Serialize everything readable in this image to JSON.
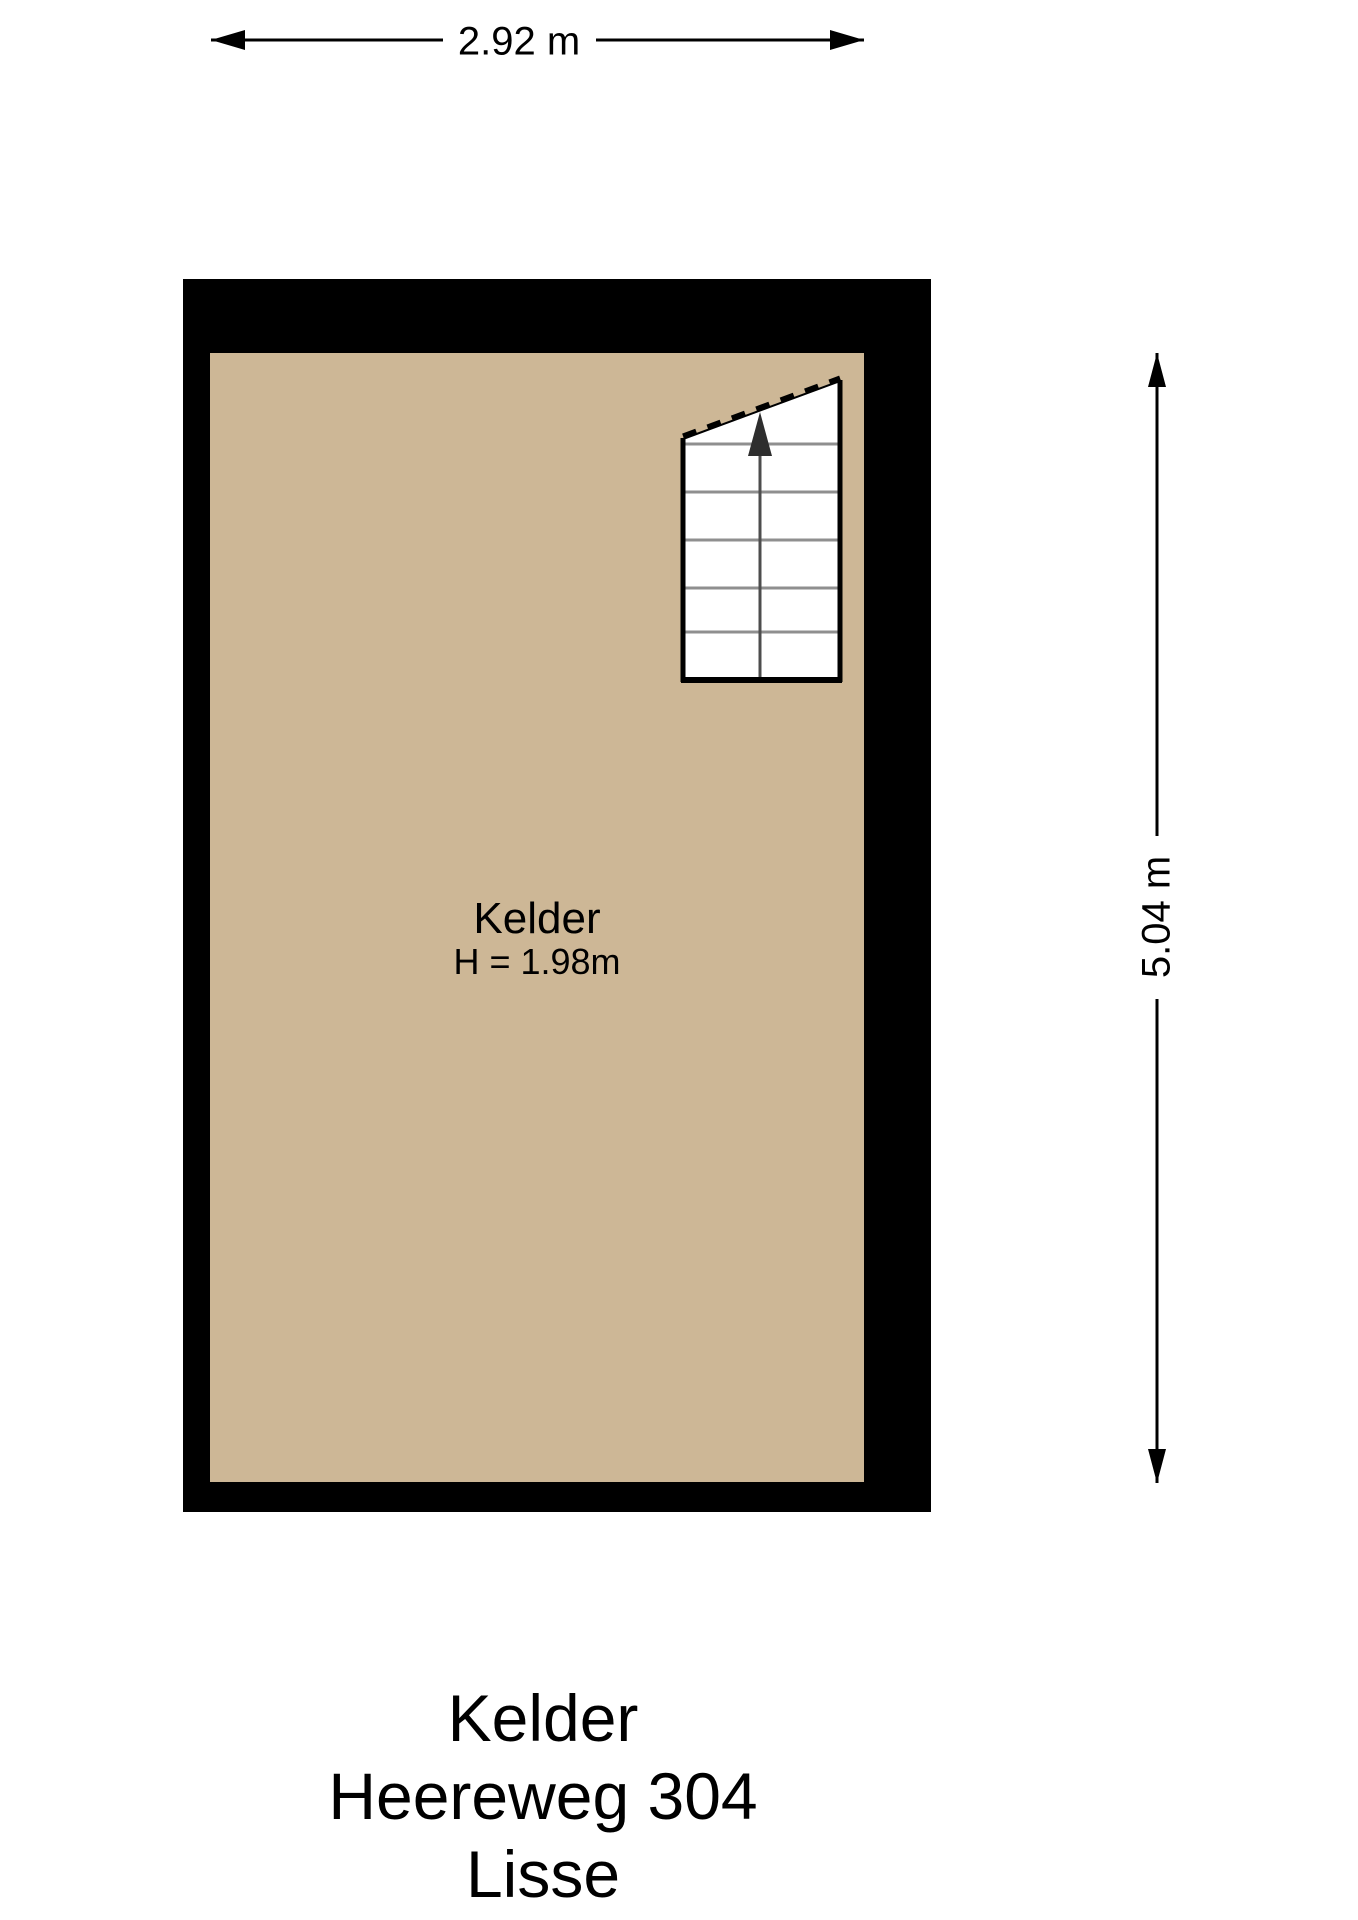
{
  "colors": {
    "background": "#ffffff",
    "wall": "#000000",
    "floor": "#cdb796",
    "stair_fill": "#ffffff",
    "stair_tread": "#8f8f8f",
    "stair_center_line": "#4d4d4d",
    "text": "#000000"
  },
  "dimensions": {
    "top_width": "2.92 m",
    "right_height": "5.04 m"
  },
  "room": {
    "name": "Kelder",
    "ceiling_height": "H = 1.98m"
  },
  "staircase": {
    "visible_steps": 6,
    "columns": 2,
    "direction": "up"
  },
  "title": {
    "line1": "Kelder",
    "line2": "Heereweg 304",
    "line3": "Lisse"
  }
}
